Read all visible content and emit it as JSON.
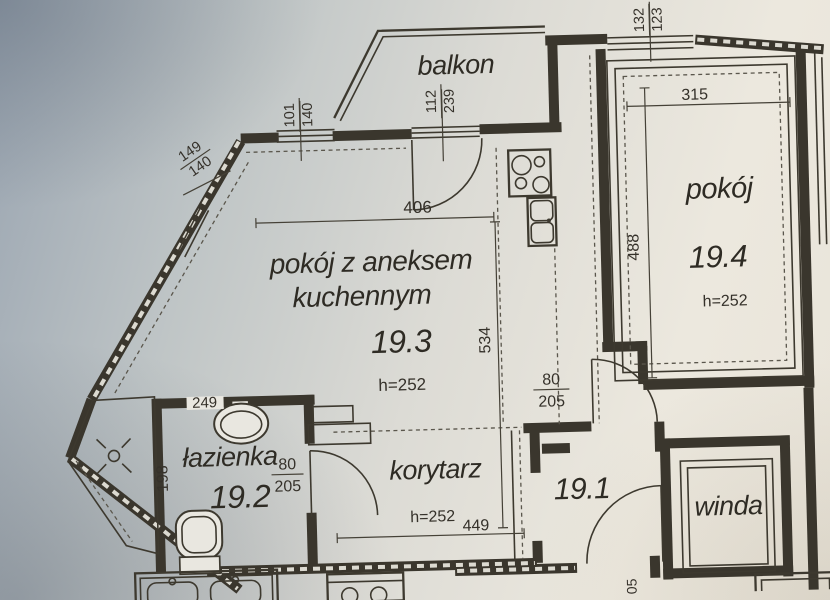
{
  "meta": {
    "document_type": "apartment floor plan photo"
  },
  "colors": {
    "ink": "#3a362d",
    "paper_light": "#ece8de",
    "paper_shadow": "#9aa5b1"
  },
  "rooms": {
    "balkon": {
      "label": "balkon"
    },
    "r193": {
      "line1": "pokój z aneksem",
      "line2": "kuchennym",
      "number": "19.3",
      "height": "h=252"
    },
    "r194": {
      "name": "pokój",
      "number": "19.4",
      "height": "h=252"
    },
    "bath": {
      "name": "łazienka",
      "number": "19.2"
    },
    "corridor": {
      "name": "korytarz",
      "height": "h=252"
    },
    "hall": {
      "number": "19.1"
    },
    "winda": {
      "label": "winda"
    }
  },
  "dims": {
    "w101": {
      "a": "101",
      "b": "140"
    },
    "w112": {
      "a": "112",
      "b": "239"
    },
    "w149": {
      "a": "149",
      "b": "140"
    },
    "w132": {
      "a": "132",
      "b": "123"
    },
    "d315": "315",
    "d406": "406",
    "d534": "534",
    "d488": "488",
    "d249": "249",
    "d198": "198",
    "d449": "449",
    "bath_door": {
      "a": "80",
      "b": "205"
    },
    "room_door": {
      "a": "80",
      "b": "205"
    },
    "cut_door": "05"
  }
}
